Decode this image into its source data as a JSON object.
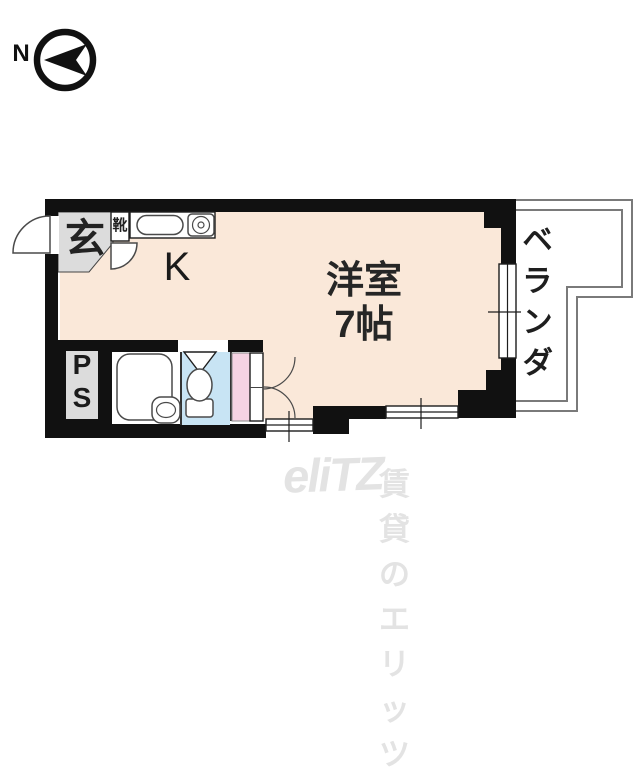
{
  "compass": {
    "label": "N"
  },
  "floorplan": {
    "rooms": {
      "genkan_label": "玄",
      "shoe_cabinet_label": "靴",
      "kitchen_label": "K",
      "main_room_name": "洋室",
      "main_room_size": "7帖",
      "veranda_label": "ベランダ",
      "pipe_space_line1": "P",
      "pipe_space_line2": "S"
    },
    "colors": {
      "wall": "#111111",
      "room_fill": "#FAE8D9",
      "toilet_fill": "#C8E4F4",
      "closet_fill": "#F6D3E3",
      "gray_fill": "#DCDCDC",
      "veranda_line": "#7a7a7a",
      "watermark": "#E3E3E3"
    }
  },
  "watermark": {
    "logo": "eliTZ",
    "text": "賃貸のエリッツ"
  }
}
